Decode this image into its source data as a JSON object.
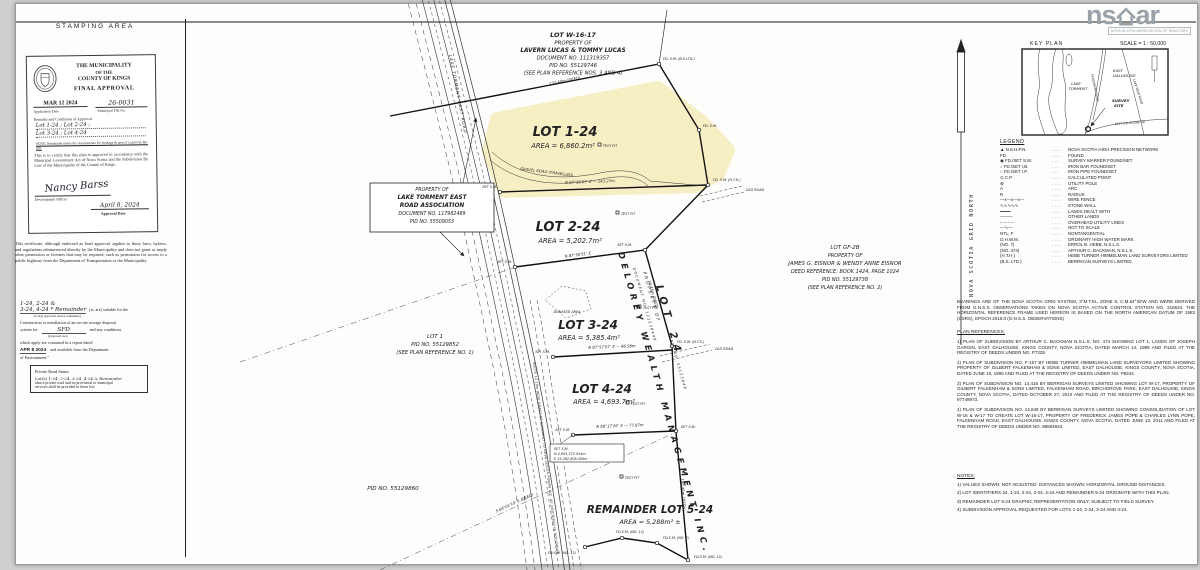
{
  "left_panel": {
    "header": "STAMPING AREA",
    "stamp": {
      "org1": "THE MUNICIPALITY",
      "org2": "OF THE",
      "org3": "COUNTY OF KINGS",
      "title": "FINAL APPROVAL",
      "date_stamp": "MAR 12 2024",
      "file_no": "26-0031",
      "application_date_label": "Application Date",
      "file_no_label": "Municipal File No.",
      "remarks_label": "Remarks and Conditions of Approval",
      "remarks1": "Lot 1-24 ;  Lot 2-24 ;",
      "remarks2": "Lot 3-24 ;  Lot 4-24",
      "note": "NOTE: Remainder meets the requirements for frontage & area of Land Use By-law.",
      "certify": "This is to certify that this plan is approved in accordance with the Municipal Government Act of Nova Scotia and the Subdivision By Law of the Municipality of the County of Kings.",
      "signature": "Nancy Barss",
      "dev_officer_label": "Development Officer",
      "approval_date": "April 8, 2024",
      "approval_date_label": "Approval Date"
    },
    "certificate": "This certificate, although endorsed as final approval, applies to those laws, bylaws, and regulations administered directly by the Municipality and does not grant or imply other permission or licenses that may be required, such as permission for access to a public highway from the Department of Transportation or the Municipality",
    "sewage": {
      "lots1": "1-24, 2-24 &",
      "lots2": "3-24, 4-24 * Remainder",
      "suitable": "(is, are) suitable for the",
      "sub1": "(Lot(s) approved and/or remainder)",
      "construction": "Construction or installation of an on-site sewage disposal",
      "system_for": "system for",
      "use": "SFD",
      "use_sub": "(proposed use)",
      "and_cond": "and any conditions",
      "which": "which apply are contained in a report dated",
      "report_date": "APR 8 2024",
      "available": "and available from the Department",
      "env": "of Environment.\""
    },
    "private_road": {
      "title": "Private Road Status",
      "line1": "Lot(s) 1-24, 2-24, 3-24, 4-24 & Remainder",
      "line2": "abut a private road and no provincial or municipal",
      "line3": "services shall be provided to these lots"
    }
  },
  "logo": {
    "left": "ns",
    "right": "ar",
    "sub": "NOVA SCOTIA ASSOCIATION OF REALTORS"
  },
  "plan": {
    "w1617": {
      "l1": "LOT W-16-17",
      "l2": "PROPERTY OF",
      "l3": "LAVERN LUCAS & TOMMY LUCAS",
      "l4": "DOCUMENT NO. 111319357",
      "l5": "PID NO. 55129746",
      "l6": "(SEE PLAN REFERENCE NOS. 3 AND 4)"
    },
    "lot1_24": {
      "name": "LOT 1-24",
      "area": "AREA = 6,860.2m²"
    },
    "lot2_24": {
      "name": "LOT 2-24",
      "area": "AREA = 5,202.7m²"
    },
    "lot3_24": {
      "name": "LOT 3-24",
      "area": "AREA = 5,385.4m²"
    },
    "lot4_24": {
      "name": "LOT 4-24",
      "area": "AREA = 4,693.7m²"
    },
    "lot5_24": {
      "name": "REMAINDER LOT 5-24",
      "area": "AREA = 5,288m² ±"
    },
    "torment": {
      "l1": "PROPERTY OF",
      "l2": "LAKE TORMENT EAST",
      "l3": "ROAD ASSOCIATION",
      "l4": "DOCUMENT NO. 117982489",
      "l5": "PID NO. 55509053"
    },
    "gf2b": {
      "l1": "LOT GF-2B",
      "l2": "PROPERTY OF",
      "l3": "JAMES G. EISNOR & WENDY ANNE EISNOR",
      "l4": "DEED REFERENCE: BOOK 1424, PAGE 1024",
      "l5": "PID NO. 55129738",
      "l6": "(SEE PLAN REFERENCE NO. 2)"
    },
    "lot1": {
      "l1": "LOT 1",
      "l2": "PID NO. 55129852",
      "l3": "(SEE PLAN REFERENCE NO. 1)"
    },
    "pid_bottom": "PID NO. 55129860",
    "delorey": {
      "lot": "LOT 24",
      "prop": "PROPERTY OF",
      "name": "DELOREY WEALTH MANAGEMENT INC.",
      "doc": "DOCUMENT NO. 121238448",
      "pid": "PID NO. 55123848"
    },
    "road_name": "LAKE TORMENT EAST ROAD",
    "gravel_road": "GRAVEL ROAD (TRAVELLED)",
    "easement": "ROUTE 12.19m WIDE GRANT OF EASEMENT TO NOVA SCOTIA POWER INC. AS DESCRIBED IN DOCUMENT",
    "donated": "DONATED AREA",
    "test_pit": "TEST PIT",
    "old_road": "OLD ROAD",
    "coord": {
      "l1": "SET S.M.",
      "l2": "N 4,953,372.054m",
      "l3": "E 25,482,808.500m"
    },
    "markers": {
      "fd_bs": "FD. S.M. (B.S.LTD.)",
      "fd": "FD. S.M.",
      "fd_hth": "FD. S.M. (H.T.H.)",
      "fd_nts": "FD. S.M. (N.T.S.)",
      "set": "SET S.M.",
      "no7": "FD.S.M. (NO. 7)",
      "no12": "FD.S.M. (NO. 12)"
    },
    "dims": {
      "lucas": "132.40m (DEED)",
      "d12": "N 87°36'07″ E — 143.27m",
      "d23": "N 87°30'51″ E",
      "d34": "N 87°57'07″ E — 86.58m",
      "d45": "N 88°17'26″ E — 77.87m",
      "diag": "74.46m (DEED)",
      "east": "140.46m (TOTAL)",
      "long": "S 64°01'10″ E (DEED)"
    }
  },
  "right_panel": {
    "north": "NOVA SCOTIA GRID NORTH",
    "key_plan": {
      "header": "KEY PLAN",
      "scale": "SCALE = 1 : 50,000",
      "lake1": "LAKE",
      "lake2": "TORMENT",
      "town1": "EAST",
      "town2": "DALHOUSIE",
      "road1": "FALKENHAM ROAD",
      "road2": "LAKE VIEW ROAD",
      "site1": "SURVEY",
      "site2": "SITE",
      "road3": "EAST DALHOUSIE RD"
    },
    "legend": {
      "header": "LEGEND",
      "rows": [
        {
          "s": "▲ N.S.H.P.N.",
          "d": "NOVA SCOTIA HIGH PRECISION NETWORK"
        },
        {
          "s": "FD.",
          "d": "FOUND"
        },
        {
          "s": "◉ FD./SET S.M.",
          "d": "SURVEY MARKER FOUND/SET"
        },
        {
          "s": "○ FD./SET I.B.",
          "d": "IRON BAR FOUND/SET"
        },
        {
          "s": "○ FD./SET I.P.",
          "d": "IRON PIPE FOUND/SET"
        },
        {
          "s": "⊙ C.P.",
          "d": "CALCULATED POINT"
        },
        {
          "s": "⊗",
          "d": "UTILITY POLE"
        },
        {
          "s": "A",
          "d": "ARC"
        },
        {
          "s": "R",
          "d": "RADIUS"
        },
        {
          "s": "—x—x—x—",
          "d": "WIRE FENCE"
        },
        {
          "s": "∿∿∿∿∿",
          "d": "STONE WALL"
        },
        {
          "s": "━━━━",
          "d": "LANDS DEALT WITH"
        },
        {
          "s": "────",
          "d": "OTHER LANDS"
        },
        {
          "s": "– – – –",
          "d": "OVERHEAD UTILITY LINES"
        },
        {
          "s": "—∿—",
          "d": "NOT TO SCALE"
        },
        {
          "s": "NTL, F",
          "d": "NONTANGENTIAL"
        },
        {
          "s": "O.H.W.M.",
          "d": "ORDINARY HIGH WATER MARK"
        },
        {
          "s": "(NO. 7)",
          "d": "ERROL B. HEBB, N.S.L.S."
        },
        {
          "s": "(NO. 474)",
          "d": "ARTHUR C. BACKMAN, N.S.L.S."
        },
        {
          "s": "(H.T.H.)",
          "d": "HEBB TURNER HIMMELMAN LAND SURVEYORS LIMITED"
        },
        {
          "s": "(B.S. LTD.)",
          "d": "BERRIGAN SURVEYS LIMITED"
        }
      ]
    },
    "bearings": "BEARINGS ARE OF THE NOVA SCOTIA GRID SYSTEM, 3°M.T.M., ZONE 5, C.M.64°30'W AND WERE DERIVED FROM G.N.S.S. OBSERVATIONS TAKEN ON NOVA SCOTIA ACTIVE CONTROL STATION NO. 216624. THE HORIZONTAL REFERENCE FRAME USED HEREON IS BASED ON THE NORTH AMERICAN DATUM OF 1983 (CSRS), EPOCH 2010.0 (G.N.S.S. OBSERVATIONS)",
    "plan_references": {
      "header": "PLAN REFERENCES:",
      "items": [
        "1) PLAN OF SUBDIVISION BY ARTHUR C. BACKMAN N.S.L.S. NO. 474 SHOWING LOT 1, LANDS OF JOSEPH GARGIN, EAST DALHOUSIE, KINGS COUNTY, NOVA SCOTIA, DATED MARCH 14, 1988 AND FILED AT THE REGISTRY OF DEEDS UNDER NO. P7225.",
        "2) PLAN OF SUBDIVISION NO. F-157 BY HEBB TURNER HIMMELMAN LAND SURVEYORS LIMITED SHOWING PROPERTY OF GILBERT FALKENHAM & SONS LIMITED, EAST DALHOUSIE, KINGS COUNTY, NOVA SCOTIA, DATED JUNE 19, 1990 AND FILED AT THE REGISTRY OF DEEDS UNDER NO. P8242.",
        "3) PLAN OF SUBDIVISION NO. 14,416 BY BERRIGAN SURVEYS LIMITED SHOWING LOT W-17, PROPERTY OF GILBERT FALKENHAM & SONS LIMITED, FALKENHAM ROAD, BIRCHGROVE PARK, EAST DALHOUSIE, KINGS COUNTY, NOVA SCOTIA, DATED OCTOBER 27, 2010 AND FILED AT THE REGISTRY OF DEEDS UNDER NO. 97749973.",
        "4) PLAN OF SUBDIVISION NO. 14,848 BY BERRIGAN SURVEYS LIMITED SHOWING CONSOLIDATION OF LOT W-16 & W-17 TO CREATE LOT W-16-17, PROPERTY OF FREDERICK JAMES POPE & CHARLES LYNN POPE, FALKENHAM ROAD, EAST DALHOUSIE, KINGS COUNTY, NOVA SCOTIA, DATED JUNE 13, 2011 AND FILED AT THE REGISTRY OF DEEDS UNDER NO. 98594923."
      ]
    },
    "notes": {
      "header": "NOTES:",
      "items": [
        "1) VALUES SHOWN: NOT ADJUSTED.  DISTANCES SHOWN: HORIZONTAL GROUND DISTANCES.",
        "2) LOT IDENTIFIERS 24, 1-24, 2-24, 3-24, 4-24 AND REMAINDER 5-24 ORIGINATE WITH THIS PLAN.",
        "3) REMAINDER LOT 5-24 GRAPHIC REPRESENTATION ONLY; SUBJECT TO FIELD SURVEY.",
        "4) SUBDIVISION APPROVAL REQUESTED FOR LOTS 1-24, 2-24, 3-24 AND 4-24."
      ]
    }
  }
}
